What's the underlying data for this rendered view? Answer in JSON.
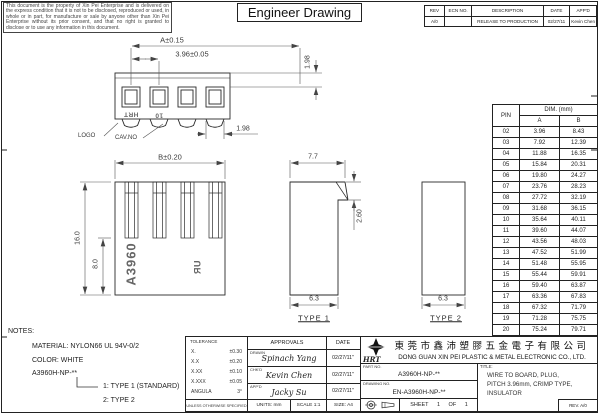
{
  "sheet": {
    "disclaimer": "This document is the property of Xin Pei Enterprise and is delivered on the express condition that it is not to be disclosed, reproduced or used, in whole or in part, for manufacture or sale by anyone other than Xin Pei Enterprise without its prior consent, and that no right is granted to disclose or to use any information in this document.",
    "title": "Engineer Drawing"
  },
  "revision_table": {
    "headers": {
      "rev": "REV",
      "ecn": "ECN NO.",
      "description": "DESCRIPTION",
      "date": "DATE",
      "appd": "APP'D"
    },
    "row": {
      "rev": "A/0",
      "ecn": "",
      "description": "RELEASE TO PRODUCTION",
      "date": "02/27/11",
      "appd": "Kevin Chen"
    }
  },
  "top_view": {
    "dim_a": "A±0.15",
    "dim_pitch": "3.96±0.05",
    "dim_height": "1.98",
    "dim_width": "1.98",
    "logo_label": "LOGO",
    "cav_no_label": "CAV.NO",
    "logo_marking": "HRT",
    "cav_marking": "10"
  },
  "front_view": {
    "dim_b": "B±0.20",
    "dim_total_height": "16.0",
    "dim_inner_height": "8.0",
    "part_marking": "A3960",
    "ul_marking": "ЯU"
  },
  "side_views": {
    "type1": {
      "label": "TYPE 1",
      "dim_top_width": "7.7",
      "dim_step": "2.60",
      "dim_bottom_width": "6.3"
    },
    "type2": {
      "label": "TYPE 2",
      "dim_bottom_width": "6.3"
    }
  },
  "pin_table": {
    "pin_label": "PIN",
    "dim_header": "DIM. (mm)",
    "col_a": "A",
    "col_b": "B",
    "rows": [
      [
        "02",
        "3.96",
        "8.43"
      ],
      [
        "03",
        "7.92",
        "12.39"
      ],
      [
        "04",
        "11.88",
        "16.35"
      ],
      [
        "05",
        "15.84",
        "20.31"
      ],
      [
        "06",
        "19.80",
        "24.27"
      ],
      [
        "07",
        "23.76",
        "28.23"
      ],
      [
        "08",
        "27.72",
        "32.19"
      ],
      [
        "09",
        "31.68",
        "36.15"
      ],
      [
        "10",
        "35.64",
        "40.11"
      ],
      [
        "11",
        "39.60",
        "44.07"
      ],
      [
        "12",
        "43.56",
        "48.03"
      ],
      [
        "13",
        "47.52",
        "51.99"
      ],
      [
        "14",
        "51.48",
        "55.95"
      ],
      [
        "15",
        "55.44",
        "59.91"
      ],
      [
        "16",
        "59.40",
        "63.87"
      ],
      [
        "17",
        "63.36",
        "67.83"
      ],
      [
        "18",
        "67.32",
        "71.79"
      ],
      [
        "19",
        "71.28",
        "75.75"
      ],
      [
        "20",
        "75.24",
        "79.71"
      ]
    ]
  },
  "notes": {
    "label": "NOTES:",
    "material": "MATERIAL: NYLON66 UL 94V-0/2",
    "color": "COLOR: WHITE",
    "part_code": "A3960H-NP-**",
    "option_1": "1: TYPE 1 (STANDARD)",
    "option_2": "2: TYPE 2"
  },
  "title_block": {
    "tolerance_label": "TOLERANCE",
    "tolerances": [
      {
        "k": "X.",
        "v": "±0.30"
      },
      {
        "k": "X.X",
        "v": "±0.20"
      },
      {
        "k": "X.XX",
        "v": "±0.10"
      },
      {
        "k": "X.XXX",
        "v": "±0.05"
      },
      {
        "k": "ANGULA",
        "v": "3°"
      }
    ],
    "unless_note": "UNLESS OTHERWISE SPECIFIED",
    "approvals_label": "APPROVALS",
    "date_label": "DATE",
    "drawn_label": "DRAWN",
    "drawn_name": "Spinach Yang",
    "drawn_date": "02/27/11\"",
    "chkd_label": "CHK'D",
    "chkd_name": "Kevin Chen",
    "chkd_date": "02/27/11\"",
    "appd_label": "APP'D",
    "appd_name": "Jacky Su",
    "appd_date": "02/27/11\"",
    "units": "UNITS: mm",
    "scale": "SCALE 1:1",
    "size": "SIZE: A4",
    "logo_text": "HRT",
    "company_cn": "東莞市鑫沛塑膠五金電子有限公司",
    "company_en": "DONG GUAN XIN PEI PLASTIC & METAL ELECTRONIC CO., LTD.",
    "part_no_label": "PART NO.",
    "part_no": "A3960H-NP-**",
    "drawing_no_label": "DRAWING NO.",
    "drawing_no": "EN-A3960H-NP-**",
    "sheet_text": "SHEET 1 OF 1",
    "title_label": "TITLE:",
    "title_line1": "WIRE TO BOARD, PLUG,",
    "title_line2": "PITCH 3.96mm, CRIMP TYPE,",
    "title_line3": "INSULATOR",
    "rev": "REV. A/0"
  }
}
